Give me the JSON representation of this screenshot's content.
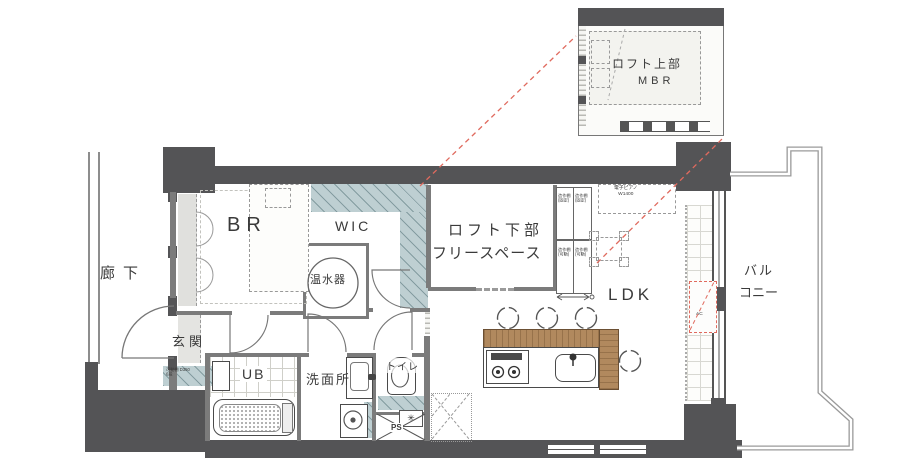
{
  "floorplan": {
    "rooms": {
      "corridor": "廊下",
      "entrance": "玄関",
      "bedroom": "BR",
      "wic": "WIC",
      "water_heater": "温水器",
      "loft_lower_line1": "ロフト下部",
      "loft_lower_line2": "フリースペース",
      "ldk": "LDK",
      "unit_bath": "UB",
      "washroom": "洗面所",
      "toilet": "トイレ",
      "pipe_space": "PS",
      "balcony_line1": "バル",
      "balcony_line2": "コニー"
    },
    "loft_inset": {
      "line1": "ロフト上部",
      "line2": "MBR"
    },
    "labels": {
      "shelf": "造作棚",
      "shelf_fixed": "(固定)",
      "shelf_movable": "(可動)",
      "piano": "電子ピアノ",
      "piano_width": "W1400",
      "ac_unit": "AC",
      "entrance_shelf_line1": "可動棚 D350",
      "entrance_shelf_line2": "6段"
    },
    "colors": {
      "wall": "#545456",
      "teal": "#becfd2",
      "wood": "#b1895e",
      "projection_red": "#e06a5e"
    }
  }
}
